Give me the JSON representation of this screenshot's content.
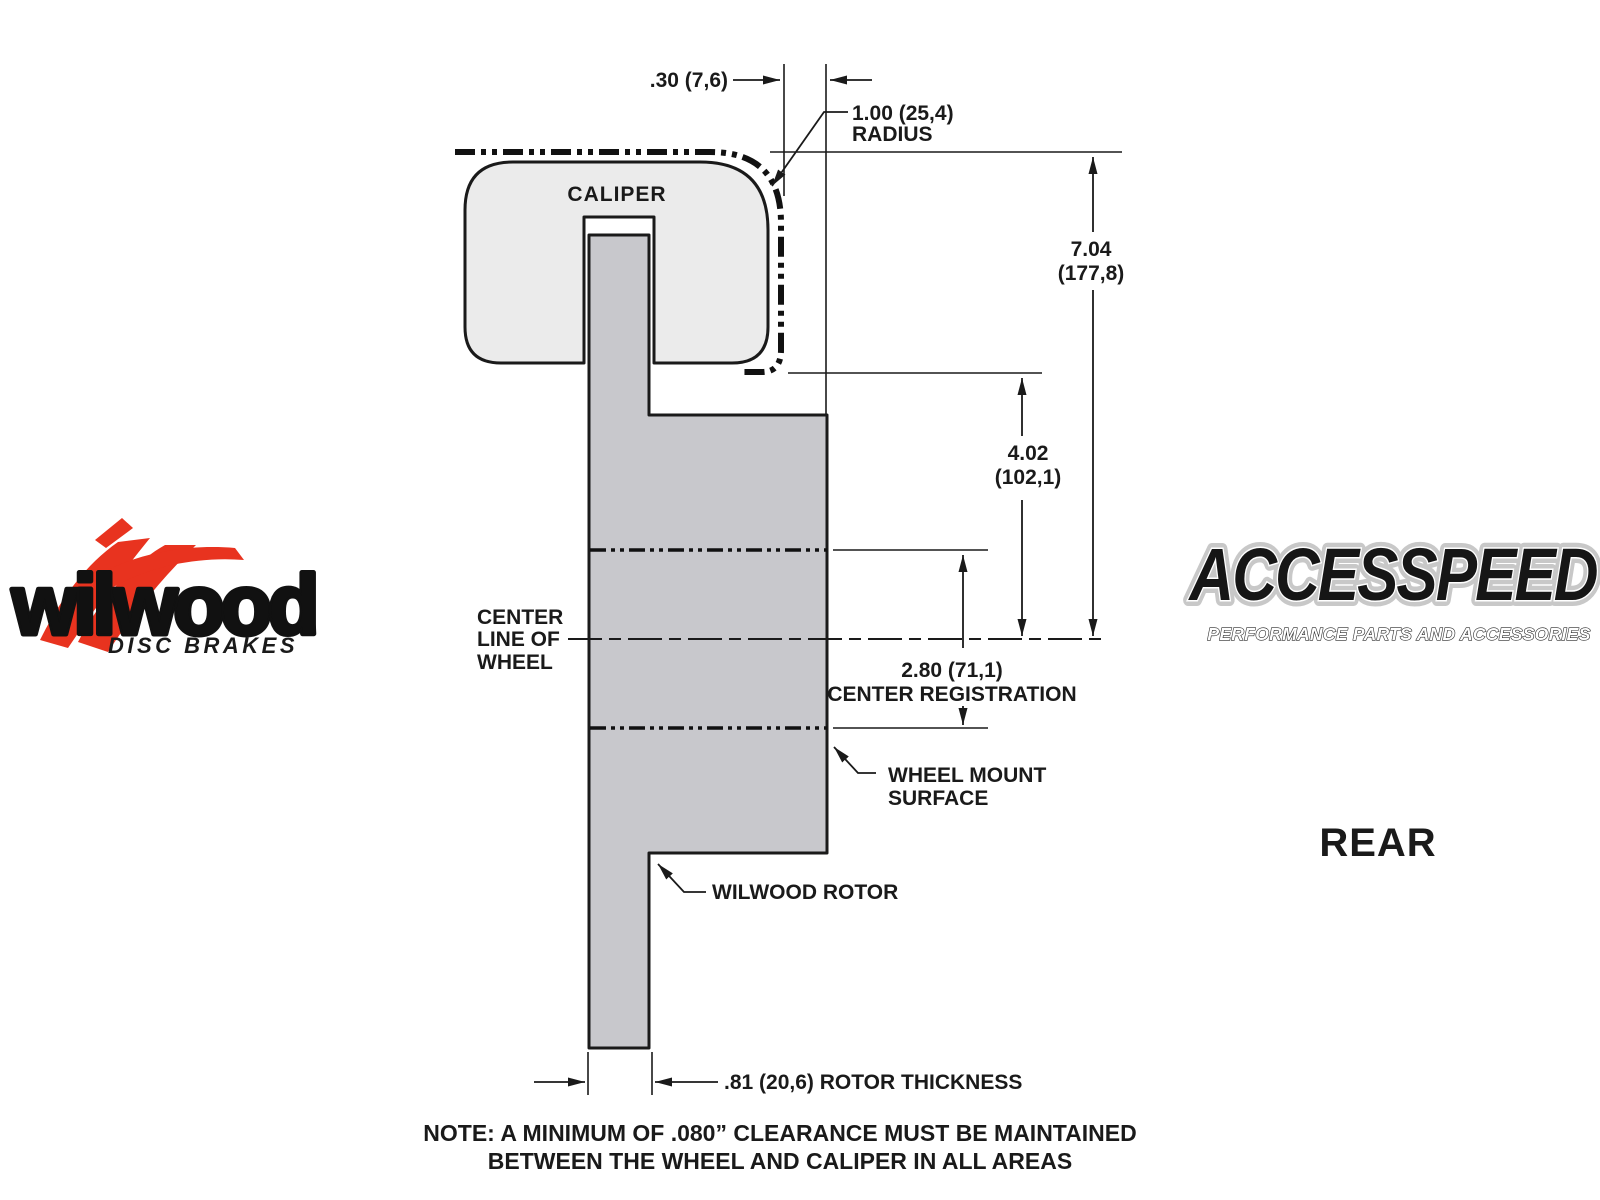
{
  "colors": {
    "background": "#ffffff",
    "line": "#1a1a1a",
    "caliper_fill": "#ebebeb",
    "rotor_fill": "#c8c8cc",
    "wilwood_red": "#e8331f"
  },
  "diagram": {
    "caliper_label": "CALIPER",
    "dim_clearance": ".30 (7,6)",
    "dim_radius_value": "1.00 (25,4)",
    "dim_radius_word": "RADIUS",
    "dim_overall_value": "7.04",
    "dim_overall_mm": "(177,8)",
    "dim_mount_value": "4.02",
    "dim_mount_mm": "(102,1)",
    "dim_registration_value": "2.80 (71,1)",
    "dim_registration_label": "CENTER REGISTRATION",
    "dim_thickness": ".81 (20,6) ROTOR THICKNESS",
    "label_centerline_1": "CENTER",
    "label_centerline_2": "LINE OF",
    "label_centerline_3": "WHEEL",
    "label_wheel_mount_1": "WHEEL MOUNT",
    "label_wheel_mount_2": "SURFACE",
    "label_rotor": "WILWOOD ROTOR",
    "note_1": "NOTE: A MINIMUM OF .080” CLEARANCE MUST BE MAINTAINED",
    "note_2": "BETWEEN THE WHEEL AND CALIPER IN ALL AREAS",
    "view_label": "REAR"
  },
  "logos": {
    "wilwood": {
      "wordmark": "wilwood",
      "subtitle": "DISC BRAKES"
    },
    "accesspeed": {
      "wordmark": "ACCESSPEED",
      "subtitle": "PERFORMANCE PARTS AND ACCESSORIES"
    }
  }
}
